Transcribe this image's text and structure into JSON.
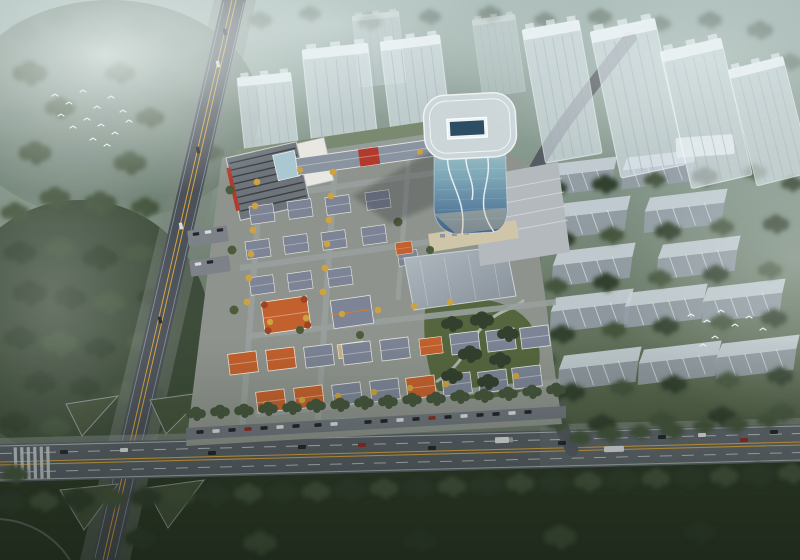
{
  "meta": {
    "title": "Bird's-eye architectural rendering of a mixed-use development masterplan at dusk",
    "type": "architectural-rendering",
    "view": "aerial"
  },
  "palette": {
    "bg-top": "#a3b6b2",
    "bg-mid": "#7f9184",
    "bg-low": "#55644b",
    "bg-bottom": "#38442f",
    "fog": "#e7f0ef",
    "forest-dark": "#33402e",
    "forest-mid": "#45553c",
    "forest-light": "#5f7050",
    "forest-misty": "#72837a",
    "lawn": "#637252",
    "site-paving": "#8e948d",
    "road-dark": "#4b5159",
    "road-main": "#585f66",
    "mark-white": "#ccd2d6",
    "mark-yellow": "#d7a33d",
    "ghost-building": "#dfe8ee",
    "slab-top": "#c5ced5",
    "slab-side": "#939ea8",
    "roof-grey": "#7c8495",
    "roof-orange": "#c2602e",
    "accent-red": "#b23a2c",
    "wall-white": "#e9e7e1",
    "tree-yellow": "#cda23f",
    "tree-green": "#4c5c3b",
    "pool-blue": "#3f8ed0",
    "glass-top": "#b6d2d4",
    "glass-mid": "#7fa9b8",
    "glass-deep": "#40628b",
    "hall-roof-light": "#b2bbc2",
    "hall-roof-dark": "#848e97",
    "plaza": "#b4b9be",
    "plaza-sun": "#cfc5a8",
    "car-dark": "#23262b",
    "car-white": "#d9dcde",
    "car-red": "#8e2b24",
    "bird": "#f2f5f4"
  },
  "scene": {
    "regions": [
      "misty forest top-left with flock of white birds",
      "semi-transparent ghost residential towers across the top",
      "rows of ghost slab housing blocks on the right among dark trees",
      "curved glass office tower with rounded roof and skylight",
      "terraced plaza at tower base",
      "long grey exhibition hall",
      "european-style low-rise village with grey mansard and orange terracotta roofs",
      "yellow autumn trees lining internal streets",
      "courtyard swimming pool",
      "pocket park with winding path",
      "tree-lined arterial road across the bottom with traffic and roadside parking",
      "secondary road running down the left side",
      "signalized intersection with triangular green islands bottom-left"
    ],
    "counts": {
      "ghost_towers": 9,
      "slab_blocks": 12,
      "vehicles_on_roads": 18,
      "parked_cars": 20,
      "pools": 1,
      "bird_flocks": 2
    }
  }
}
